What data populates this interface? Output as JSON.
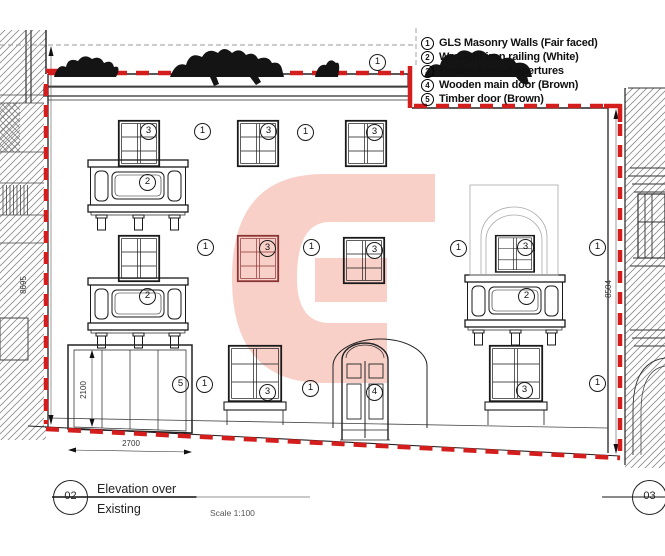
{
  "legend": {
    "items": [
      {
        "num": "1",
        "label": "GLS Masonry Walls (Fair faced)"
      },
      {
        "num": "2",
        "label": "Wrought iron railing (White)"
      },
      {
        "num": "3",
        "label": "Timber framed apertures"
      },
      {
        "num": "4",
        "label": "Wooden main door (Brown)"
      },
      {
        "num": "5",
        "label": "Timber door (Brown)"
      }
    ]
  },
  "dimensions": {
    "left_height": "8695",
    "right_height": "8504",
    "garage_height": "2100",
    "garage_width": "2700"
  },
  "markers": [
    {
      "num": "1",
      "x": 377,
      "y": 62
    },
    {
      "num": "3",
      "x": 148,
      "y": 131
    },
    {
      "num": "1",
      "x": 202,
      "y": 131
    },
    {
      "num": "3",
      "x": 268,
      "y": 131
    },
    {
      "num": "1",
      "x": 305,
      "y": 132
    },
    {
      "num": "3",
      "x": 374,
      "y": 132
    },
    {
      "num": "2",
      "x": 147,
      "y": 182
    },
    {
      "num": "1",
      "x": 205,
      "y": 247
    },
    {
      "num": "3",
      "x": 267,
      "y": 248
    },
    {
      "num": "1",
      "x": 311,
      "y": 247
    },
    {
      "num": "3",
      "x": 374,
      "y": 250
    },
    {
      "num": "1",
      "x": 458,
      "y": 248
    },
    {
      "num": "3",
      "x": 525,
      "y": 247
    },
    {
      "num": "1",
      "x": 597,
      "y": 247
    },
    {
      "num": "2",
      "x": 147,
      "y": 296
    },
    {
      "num": "2",
      "x": 526,
      "y": 296
    },
    {
      "num": "5",
      "x": 180,
      "y": 384
    },
    {
      "num": "1",
      "x": 204,
      "y": 384
    },
    {
      "num": "3",
      "x": 267,
      "y": 392
    },
    {
      "num": "1",
      "x": 310,
      "y": 388
    },
    {
      "num": "4",
      "x": 374,
      "y": 392
    },
    {
      "num": "3",
      "x": 524,
      "y": 390
    },
    {
      "num": "1",
      "x": 597,
      "y": 383
    }
  ],
  "title_block": {
    "sheet_number": "02",
    "line1": "Elevation over",
    "line2": "Existing",
    "scale": "Scale 1:100"
  },
  "adjacent_sheet": {
    "number": "03"
  },
  "colors": {
    "boundary_red": "#d41d1d",
    "watermark_pink": "#f8d0c8"
  }
}
